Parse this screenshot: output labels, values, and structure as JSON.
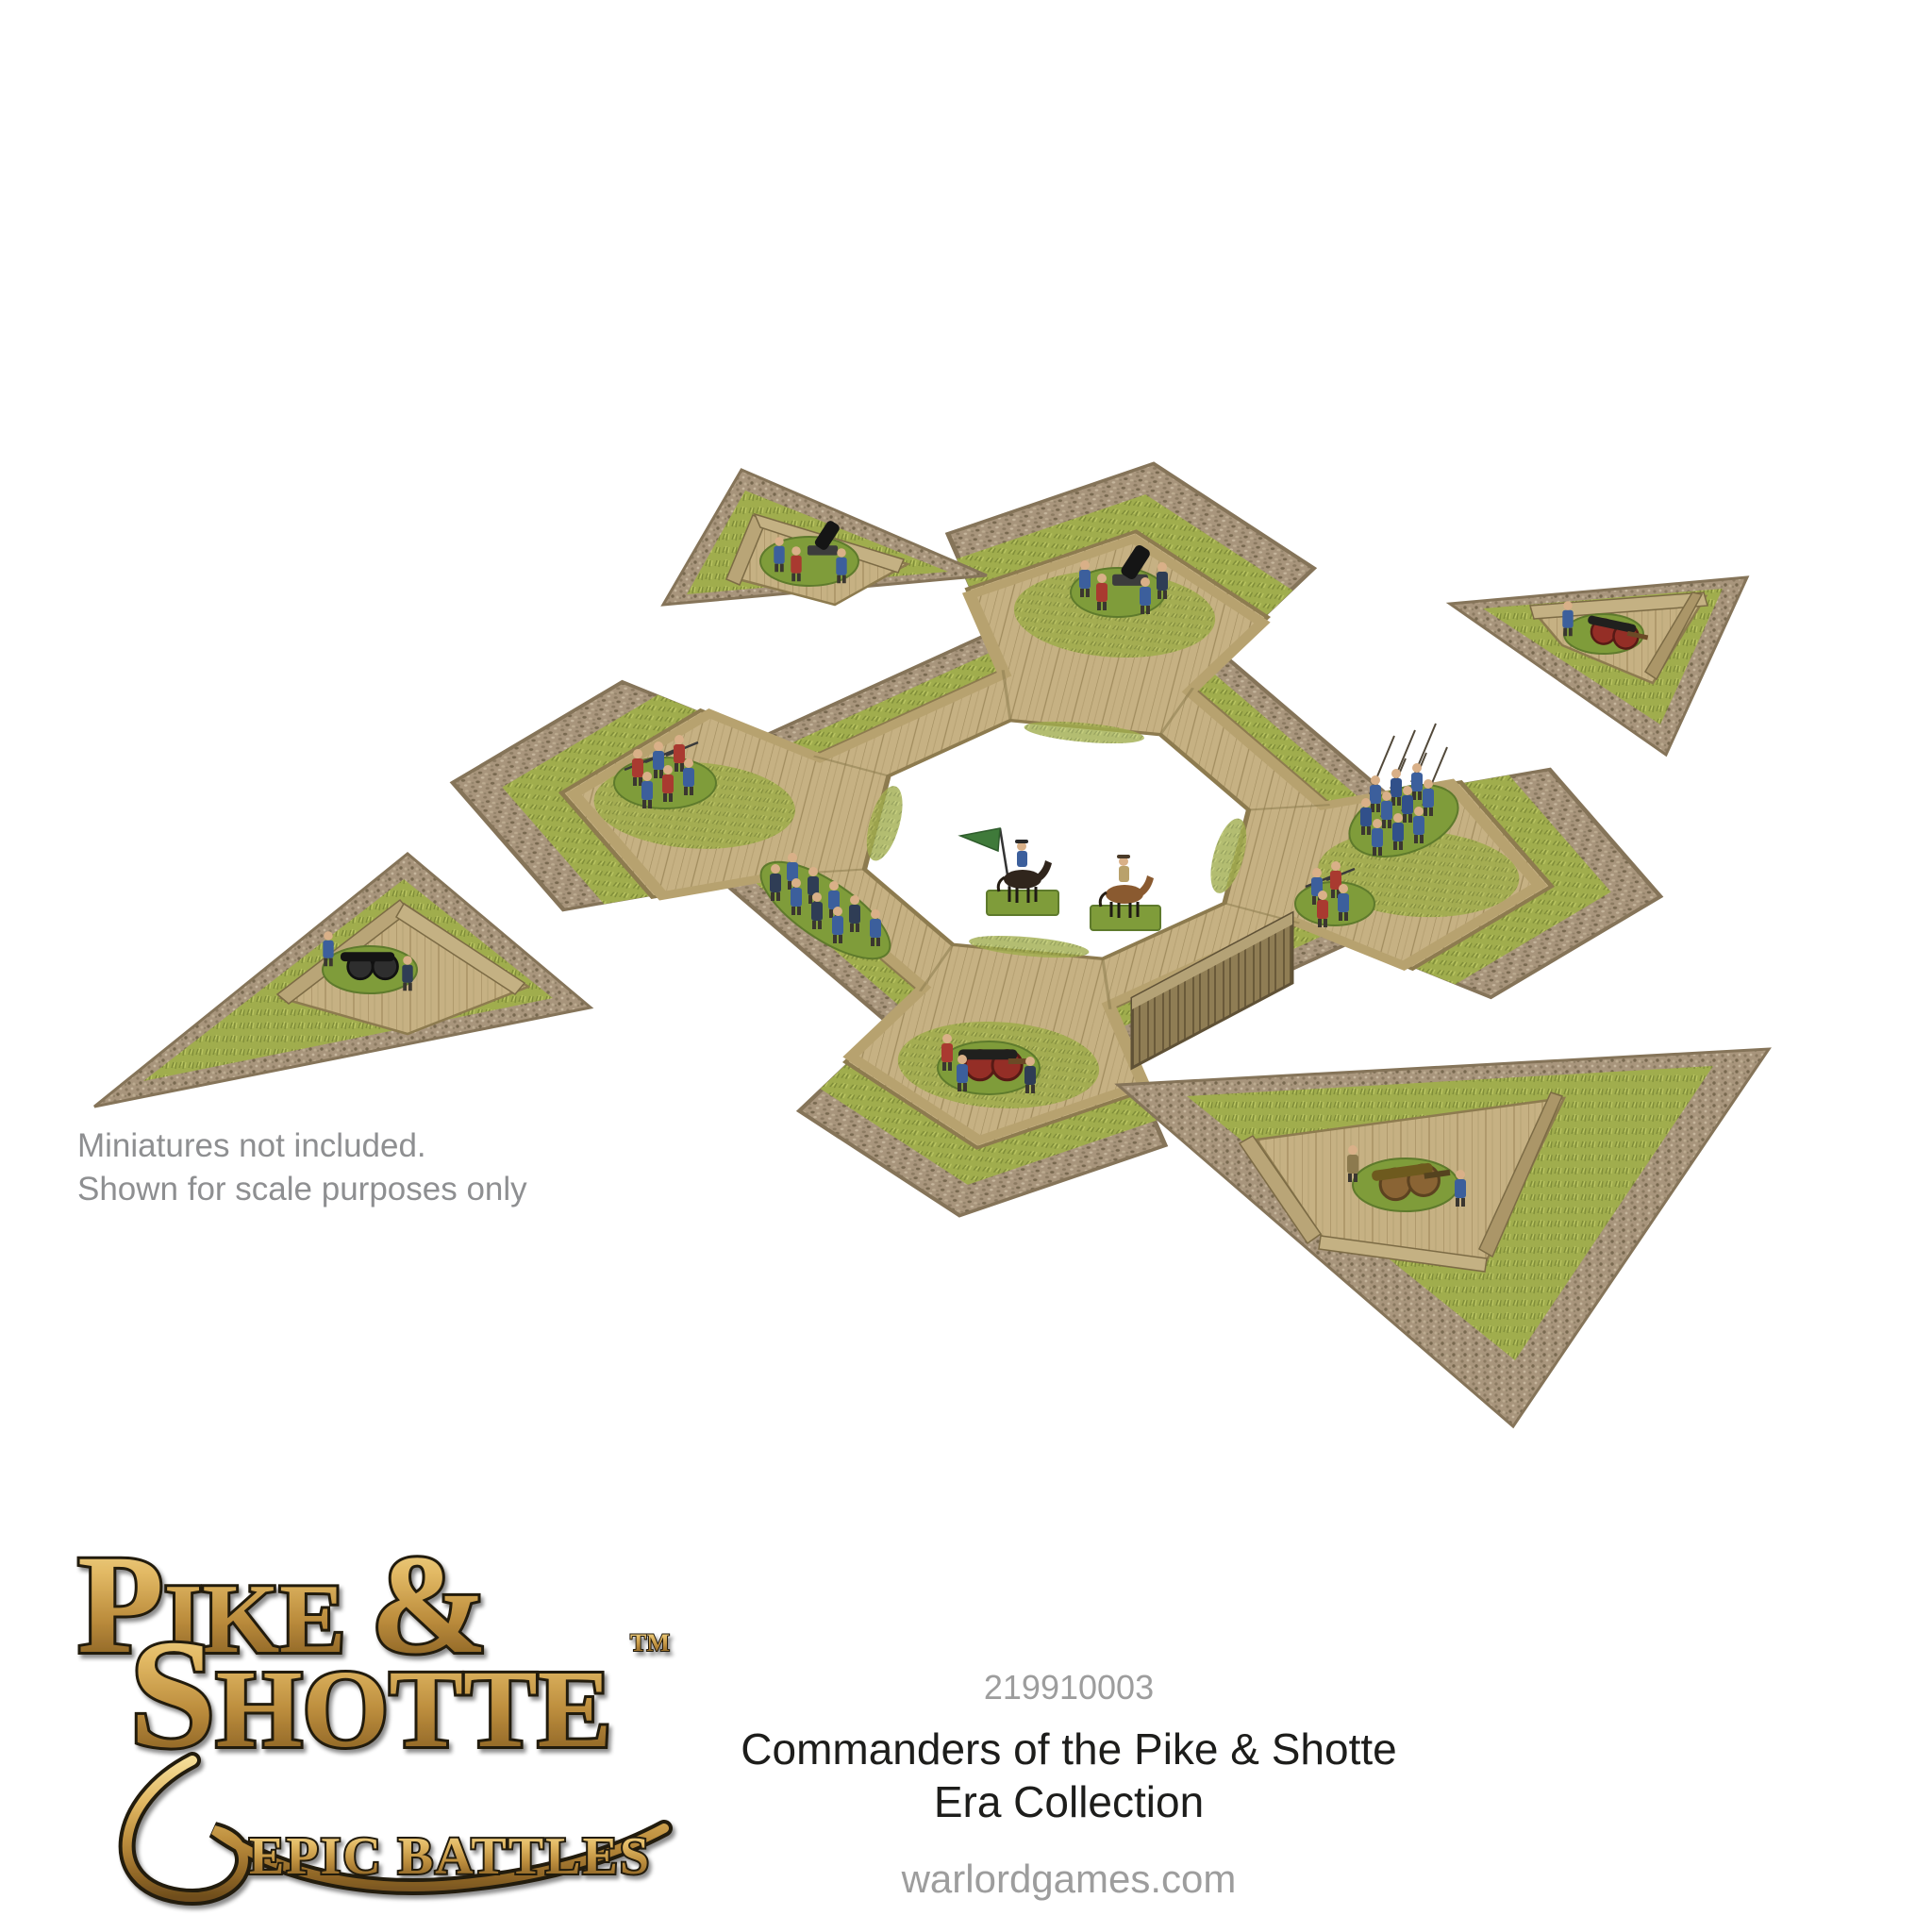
{
  "page": {
    "background": "#ffffff"
  },
  "annotation": {
    "line1": "Miniatures not included.",
    "line2": "Shown for scale purposes only",
    "color": "#8e8f91"
  },
  "product": {
    "code": "219910003",
    "title_line1": "Commanders of the Pike & Shotte",
    "title_line2": "Era Collection",
    "website": "warlordgames.com",
    "code_color": "#9d9d9d",
    "title_color": "#1d1d1b"
  },
  "logo": {
    "l1i": "P",
    "l1r": "IKE ",
    "l1a": "&",
    "l2i": "S",
    "l2r": "HOTTE",
    "tm": "TM",
    "subtitle": "EPIC BATTLES",
    "gold_light": "#f4dc96",
    "gold_dark": "#6f4e1d",
    "outline": "#221a0e"
  },
  "scene": {
    "type": "product-photo",
    "subject": "Modular MDF star fort wargaming terrain with four detached triangular ravelins and example miniatures",
    "fort": {
      "bastions": 4,
      "contents": [
        "siege cannon crew on north bastion",
        "musketeer unit on west bastion",
        "blue pike block on east bastion",
        "infantry column on southwest wall",
        "red-wheeled cannon on south bastion",
        "musketeers by southeast wall",
        "palisade gate section",
        "two mounted commanders in courtyard"
      ]
    },
    "ravelins": [
      {
        "position": "upper-left",
        "contents": "mortar with crew"
      },
      {
        "position": "upper-right",
        "contents": "red-wheeled cannon with crew"
      },
      {
        "position": "left",
        "contents": "black field cannon with crew"
      },
      {
        "position": "lower-right",
        "contents": "wooden field cannon with crew"
      }
    ],
    "colors": {
      "mdf_tan": "#c6b183",
      "mdf_dark": "#8d7b4f",
      "grass": "#a0ad4d",
      "gravel": "#a8957c",
      "base_green": "#7f9c3a",
      "uniform_blue": "#3c5f9c",
      "uniform_red": "#a93a30",
      "flag_green": "#3f7a3a",
      "horse_brown": "#8a5a30",
      "horse_black": "#30251c"
    }
  }
}
